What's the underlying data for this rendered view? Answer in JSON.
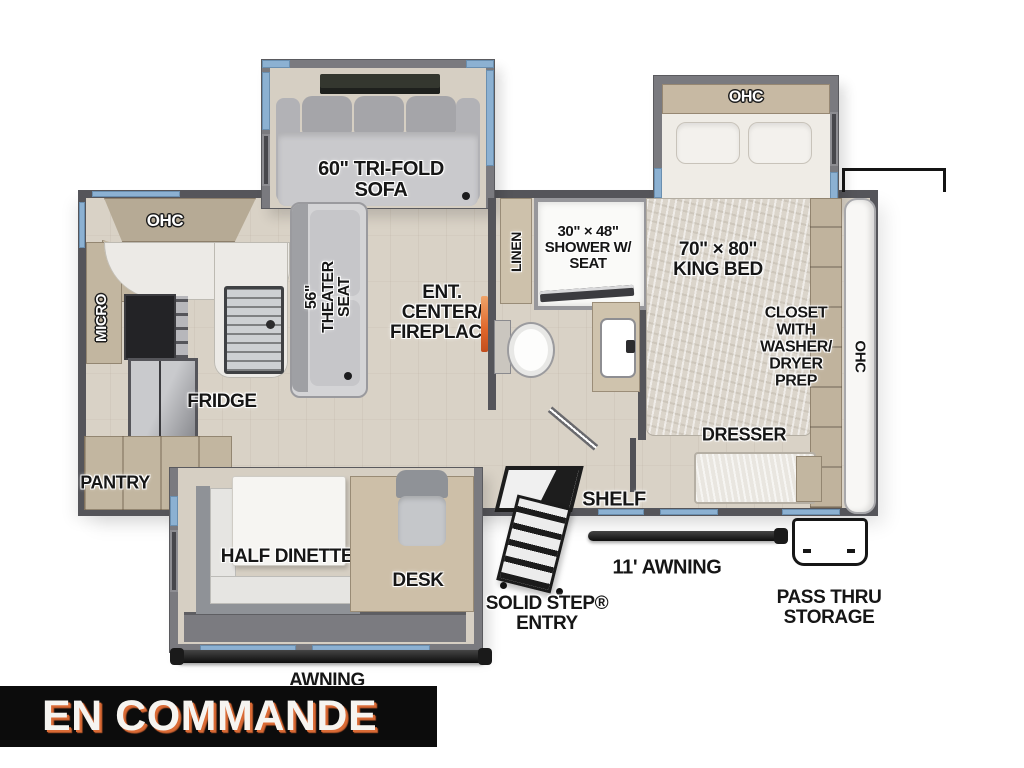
{
  "banner": {
    "text": "EN COMMANDE"
  },
  "kitchen": {
    "ohc": "OHC",
    "micro": "MICRO",
    "fridge": "FRIDGE",
    "pantry": "PANTRY"
  },
  "living": {
    "sofa": "60\" TRI-FOLD\nSOFA",
    "theater": "56\"\nTHEATER\nSEAT",
    "ent_center": "ENT.\nCENTER/\nFIREPLACE"
  },
  "bath": {
    "linen": "LINEN",
    "shower": "30\" × 48\"\nSHOWER W/\nSEAT"
  },
  "bedroom": {
    "ohc": "OHC",
    "king_bed": "70\" × 80\"\nKING BED",
    "closet": "CLOSET\nWITH\nWASHER/\nDRYER\nPREP",
    "dresser": "DRESSER",
    "rear_ohc": "OHC"
  },
  "dinette": {
    "half_dinette": "HALF DINETTE",
    "desk": "DESK"
  },
  "exterior": {
    "shelf": "SHELF",
    "solid_step_entry": "SOLID STEP®\nENTRY",
    "awning_door_side": "11' AWNING",
    "awning_camp_side": "AWNING",
    "pass_thru": "PASS THRU\nSTORAGE"
  },
  "colors": {
    "wall_gray": "#55555a",
    "slide_wall_gray": "#7a7a7f",
    "floor_beige": "#d9d2c6",
    "cabinet_tan": "#c2b6a0",
    "window_blue": "#8cb1d2",
    "fireplace_orange": "#e0662a",
    "banner_bg": "#0c0c0c",
    "banner_text": "#f6f4f0",
    "banner_shadow": "#d96a35"
  }
}
